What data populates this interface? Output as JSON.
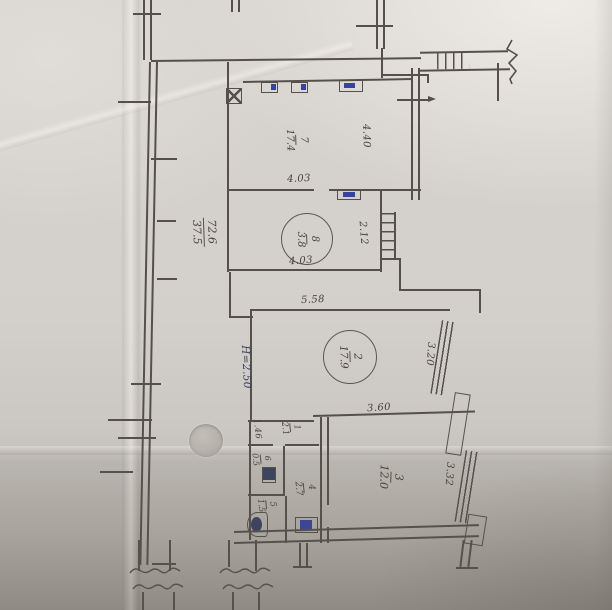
{
  "plan": {
    "totals": {
      "numerator": "72.6",
      "denominator": "37.5"
    },
    "ceiling_height": "H=2.50",
    "rooms": {
      "r1": {
        "number": "1",
        "area": "2.1"
      },
      "r2": {
        "number": "2",
        "area": "17.9"
      },
      "r3": {
        "number": "3",
        "area": "12.0"
      },
      "r4": {
        "number": "4",
        "area": "2.7"
      },
      "r5": {
        "number": "5",
        "area": "1.5"
      },
      "r6": {
        "number": "6",
        "area": "0.5"
      },
      "r7": {
        "number": "7",
        "area": "17.4"
      },
      "r8": {
        "number": "8",
        "area": "3.8"
      }
    },
    "dims": {
      "d440": "4.40",
      "d403a": "4.03",
      "d403b": "4.03",
      "d212": "2.12",
      "d558": "5.58",
      "d320": "3.20",
      "d360": "3.60",
      "d332": "3.32",
      "d146": "1.46"
    },
    "colors": {
      "pencil": "#55514a",
      "ink_blue": "#36449c",
      "paper": "#d3cfca"
    }
  }
}
